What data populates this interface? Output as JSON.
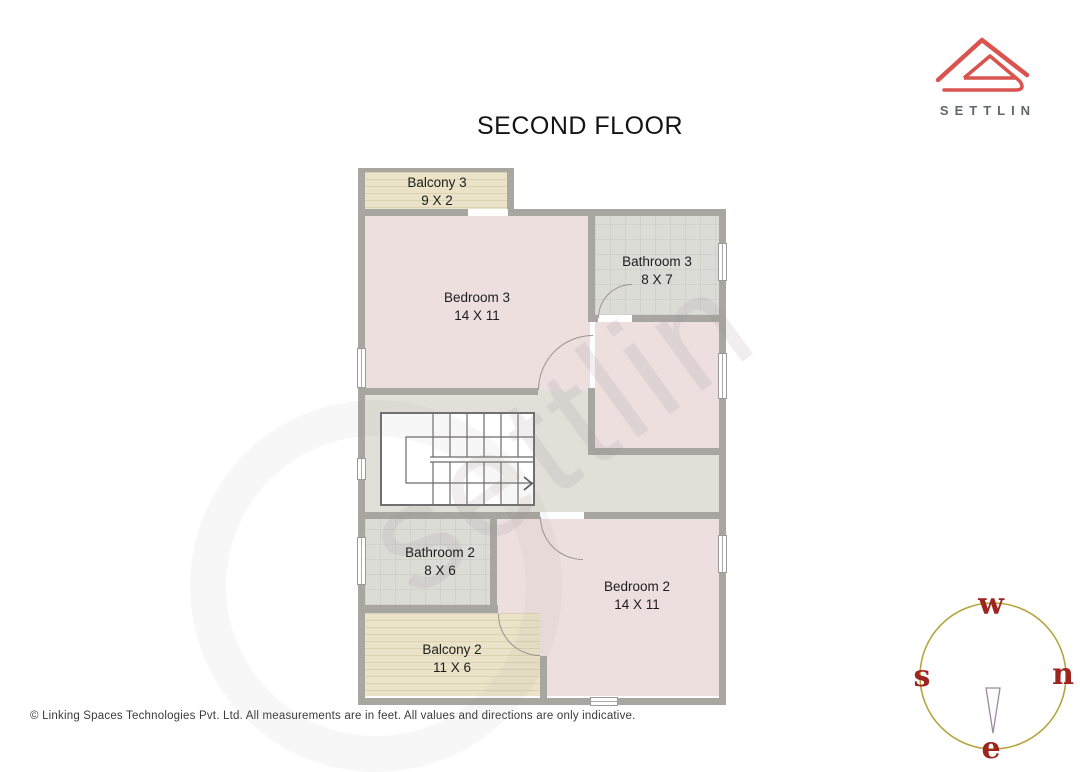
{
  "page": {
    "title": "SECOND FLOOR"
  },
  "brand": {
    "name": "SETTLIN",
    "logo_color": "#d9534f",
    "name_color": "#63666a"
  },
  "watermark": {
    "text": "settlin"
  },
  "floor_plan": {
    "rooms": {
      "balcony3": {
        "name": "Balcony 3",
        "size": "9 X 2"
      },
      "bedroom3": {
        "name": "Bedroom 3",
        "size": "14 X 11"
      },
      "bathroom3": {
        "name": "Bathroom 3",
        "size": "8 X 7"
      },
      "bathroom2": {
        "name": "Bathroom 2",
        "size": "8 X 6"
      },
      "bedroom2": {
        "name": "Bedroom 2",
        "size": "14 X 11"
      },
      "balcony2": {
        "name": "Balcony 2",
        "size": "11 X 6"
      }
    },
    "colors": {
      "bedroom_fill": "#ecdfde",
      "bathroom_fill": "#dcdcd7",
      "balcony_fill": "#eae3c8",
      "hall_fill": "#e0e0d9",
      "wall": "#a8a6a1"
    }
  },
  "compass": {
    "top": "w",
    "left": "s",
    "right": "n",
    "bottom": "e",
    "ring_color": "#b5a43c",
    "letter_color": "#9e2420"
  },
  "footer": {
    "text": "© Linking Spaces Technologies Pvt. Ltd. All measurements are in feet. All values and directions are only indicative."
  }
}
